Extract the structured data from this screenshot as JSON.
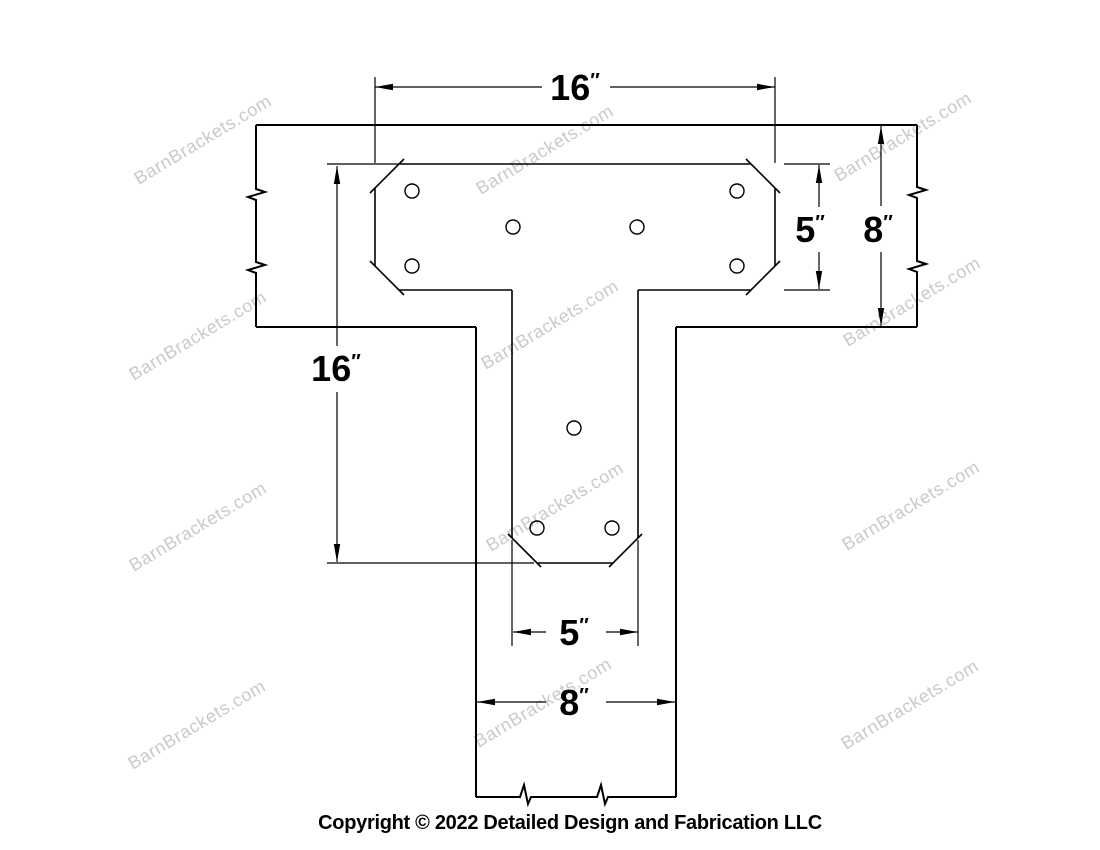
{
  "watermark": {
    "text": "BarnBrackets.com",
    "color": "#c9c9c9"
  },
  "footer": {
    "copyright": "Copyright © 2022 Detailed Design and Fabrication LLC"
  },
  "dimensions": {
    "plate_width": {
      "value": "16",
      "unit": "″"
    },
    "plate_height": {
      "value": "5",
      "unit": "″"
    },
    "beam_depth": {
      "value": "8",
      "unit": "″"
    },
    "leg_length": {
      "value": "16",
      "unit": "″"
    },
    "leg_width": {
      "value": "5",
      "unit": "″"
    },
    "post_width": {
      "value": "8",
      "unit": "″"
    }
  },
  "drawing": {
    "line_color": "#000000",
    "background": "#ffffff",
    "bolt_hole_count": 9
  }
}
